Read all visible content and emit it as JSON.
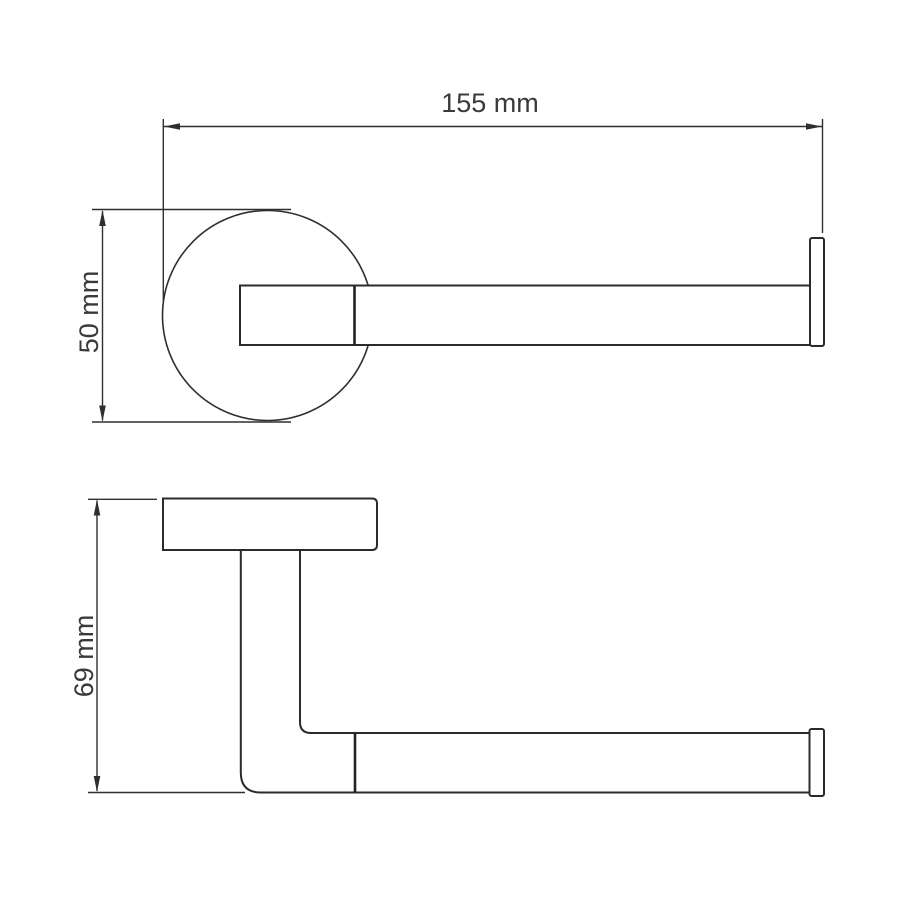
{
  "drawing": {
    "type": "technical-dimension-drawing",
    "subject": "wall-mounted toilet paper holder, two orthographic views",
    "labels": {
      "width": "155 mm",
      "front_height": "50 mm",
      "side_height": "69 mm"
    },
    "colors": {
      "background": "#ffffff",
      "line": "#2f2f2f",
      "object_line": "#2b2b2b",
      "text": "#3a3a3a"
    }
  }
}
